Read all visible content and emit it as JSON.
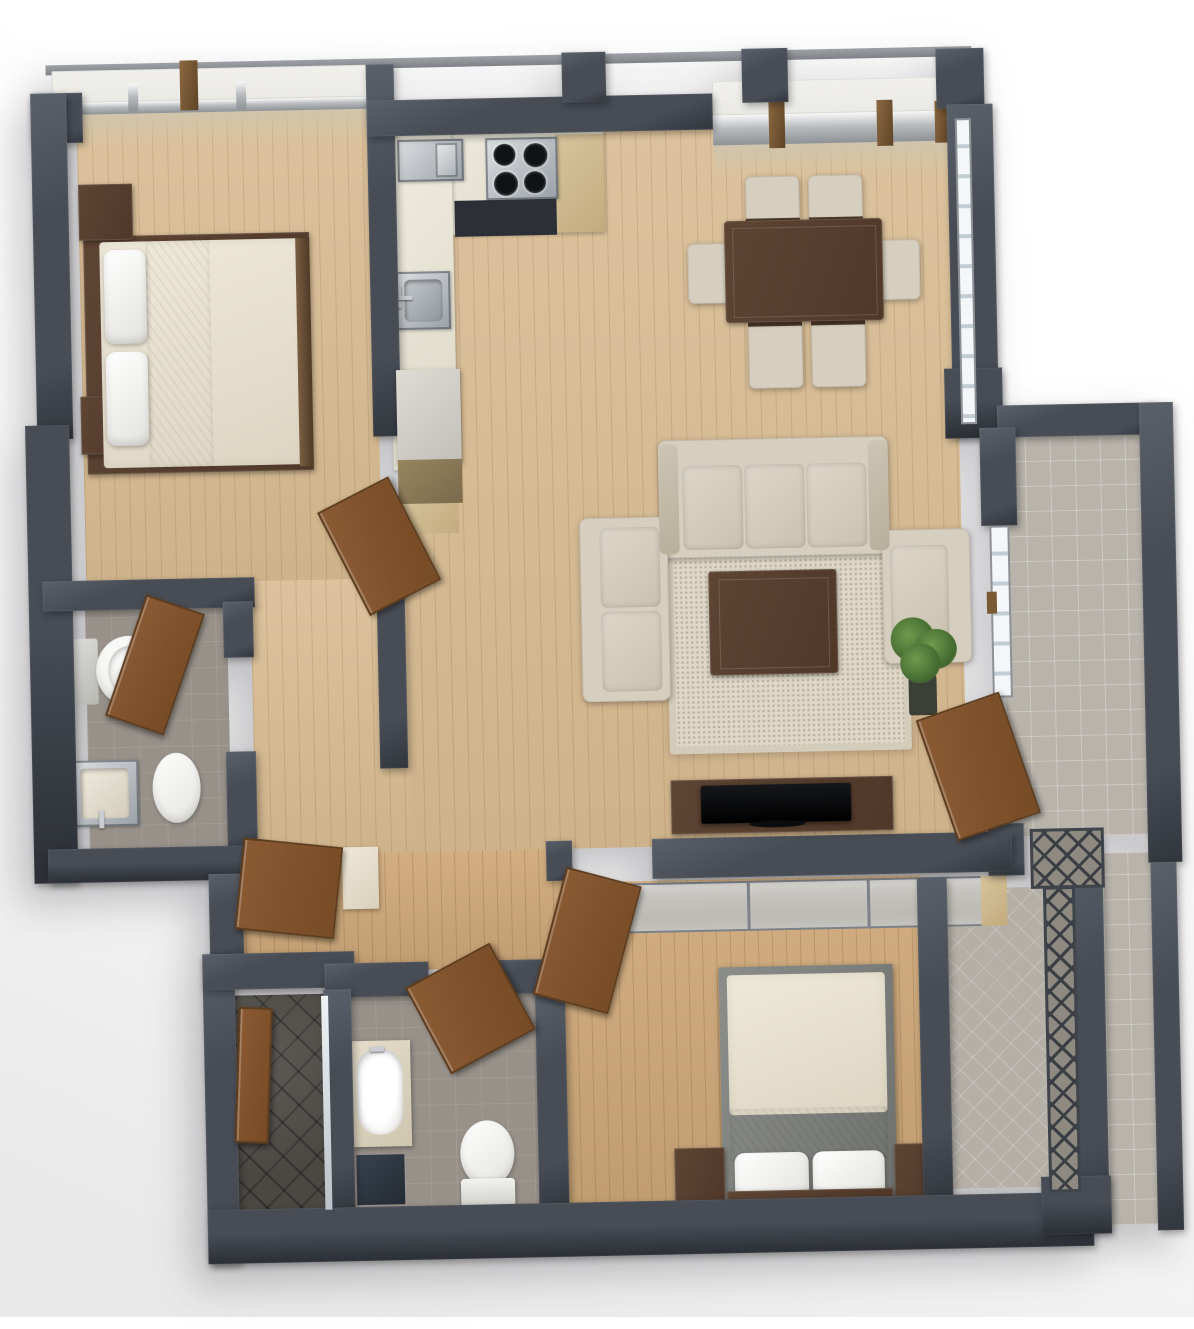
{
  "meta": {
    "kind": "3d-rendered-floor-plan",
    "view": "top-down",
    "text_labels": []
  },
  "palette": {
    "background": "#fbfbfb",
    "wall": "#474c55",
    "wall_dark": "#32363d",
    "wall_light": "#5a6069",
    "wood_floor": "#d9bc92",
    "wood_floor_deep": "#cfa97a",
    "bath_tile": "#98918a",
    "balcony_tile": "#b8b3ab",
    "shower_slate": "#4b4843",
    "counter": "#e8e4d7",
    "steel": "#9aa0a6",
    "walnut": "#5d4433",
    "door_wood": "#8a5a33",
    "sofa_fabric": "#d6cfc0",
    "bedding": "#e8e2d4",
    "linen_white": "#f4f3ef",
    "rug": "#ded7c7",
    "glass": "#c2ccd3",
    "plant": "#4e7a3a"
  },
  "rooms": [
    {
      "name": "bedroom-1",
      "floor": "wood",
      "furniture": [
        "double-bed",
        "nightstand",
        "nightstand",
        "wardrobe"
      ]
    },
    {
      "name": "kitchen",
      "floor": "wood",
      "furniture": [
        "l-counter",
        "microwave",
        "cooktop-4-burner",
        "oven",
        "sink",
        "open-shelf"
      ]
    },
    {
      "name": "dining-area",
      "floor": "wood",
      "furniture": [
        "dining-table",
        "chair",
        "chair",
        "chair",
        "chair",
        "chair",
        "chair"
      ]
    },
    {
      "name": "living-room",
      "floor": "wood",
      "furniture": [
        "sofa-3-seat",
        "loveseat",
        "armchair",
        "coffee-table",
        "shag-rug",
        "tv-console",
        "tv",
        "potted-plant"
      ]
    },
    {
      "name": "hallway",
      "floor": "wood",
      "furniture": [
        "entry-door",
        "hall-cabinet"
      ]
    },
    {
      "name": "bathroom-1",
      "floor": "tile",
      "furniture": [
        "toilet",
        "sink",
        "waste-bin",
        "door"
      ]
    },
    {
      "name": "shower-room",
      "floor": "dark-slate",
      "furniture": [
        "glass-screen"
      ]
    },
    {
      "name": "bathroom-2",
      "floor": "tile",
      "furniture": [
        "vanity-basin",
        "cabinet",
        "toilet",
        "door"
      ]
    },
    {
      "name": "bedroom-2",
      "floor": "wood",
      "furniture": [
        "double-bed",
        "nightstand",
        "nightstand",
        "sliding-closet",
        "door"
      ]
    },
    {
      "name": "balcony-main",
      "floor": "tile",
      "furniture": [
        "sliding-glass-door"
      ]
    },
    {
      "name": "balcony-bedroom-2",
      "floor": "tile",
      "furniture": [
        "lattice-railing"
      ]
    }
  ],
  "openings": {
    "windows": [
      "bedroom-1-north",
      "dining-north",
      "dining-east"
    ],
    "doors": 6
  }
}
